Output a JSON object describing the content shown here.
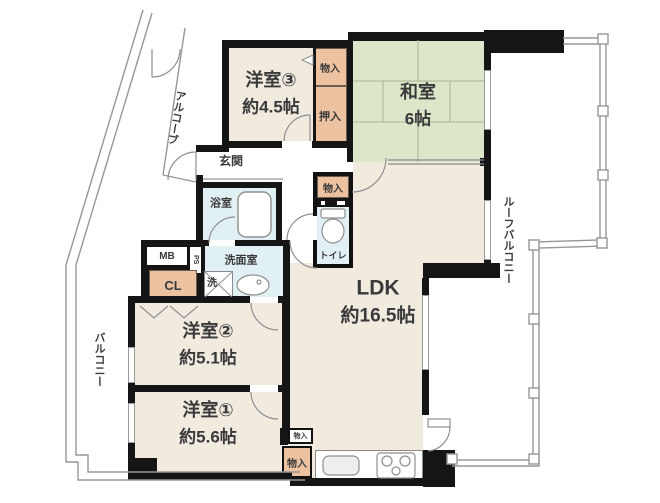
{
  "rooms": {
    "yoshitsu3": {
      "name": "洋室③",
      "size": "約4.5帖"
    },
    "washitsu": {
      "name": "和室",
      "size": "6帖"
    },
    "ldk": {
      "name": "LDK",
      "size": "約16.5帖"
    },
    "yoshitsu2": {
      "name": "洋室②",
      "size": "約5.1帖"
    },
    "yoshitsu1": {
      "name": "洋室①",
      "size": "約5.6帖"
    },
    "genkan": {
      "name": "玄関"
    },
    "bathroom": {
      "name": "浴室"
    },
    "washroom": {
      "name": "洗面室"
    },
    "toilet": {
      "name": "トイレ"
    }
  },
  "storage": {
    "monoire_top": "物入",
    "oshiire": "押入",
    "monoire_hall": "物入",
    "closet": "CL",
    "meter_box": "MB",
    "pipe_shaft": "PS",
    "washer": "洗",
    "monoire_small": "物入",
    "monoire_lower": "物入"
  },
  "outdoor": {
    "alcove": "アルコーブ",
    "balcony": "バルコニー",
    "roof_balcony": "ルーフバルコニー"
  },
  "colors": {
    "room": "#f0eadf",
    "tatami": "#dce6c9",
    "storage": "#ecc2a0",
    "wet": "#e1f0f2",
    "wall": "#151515",
    "line": "#979797"
  }
}
